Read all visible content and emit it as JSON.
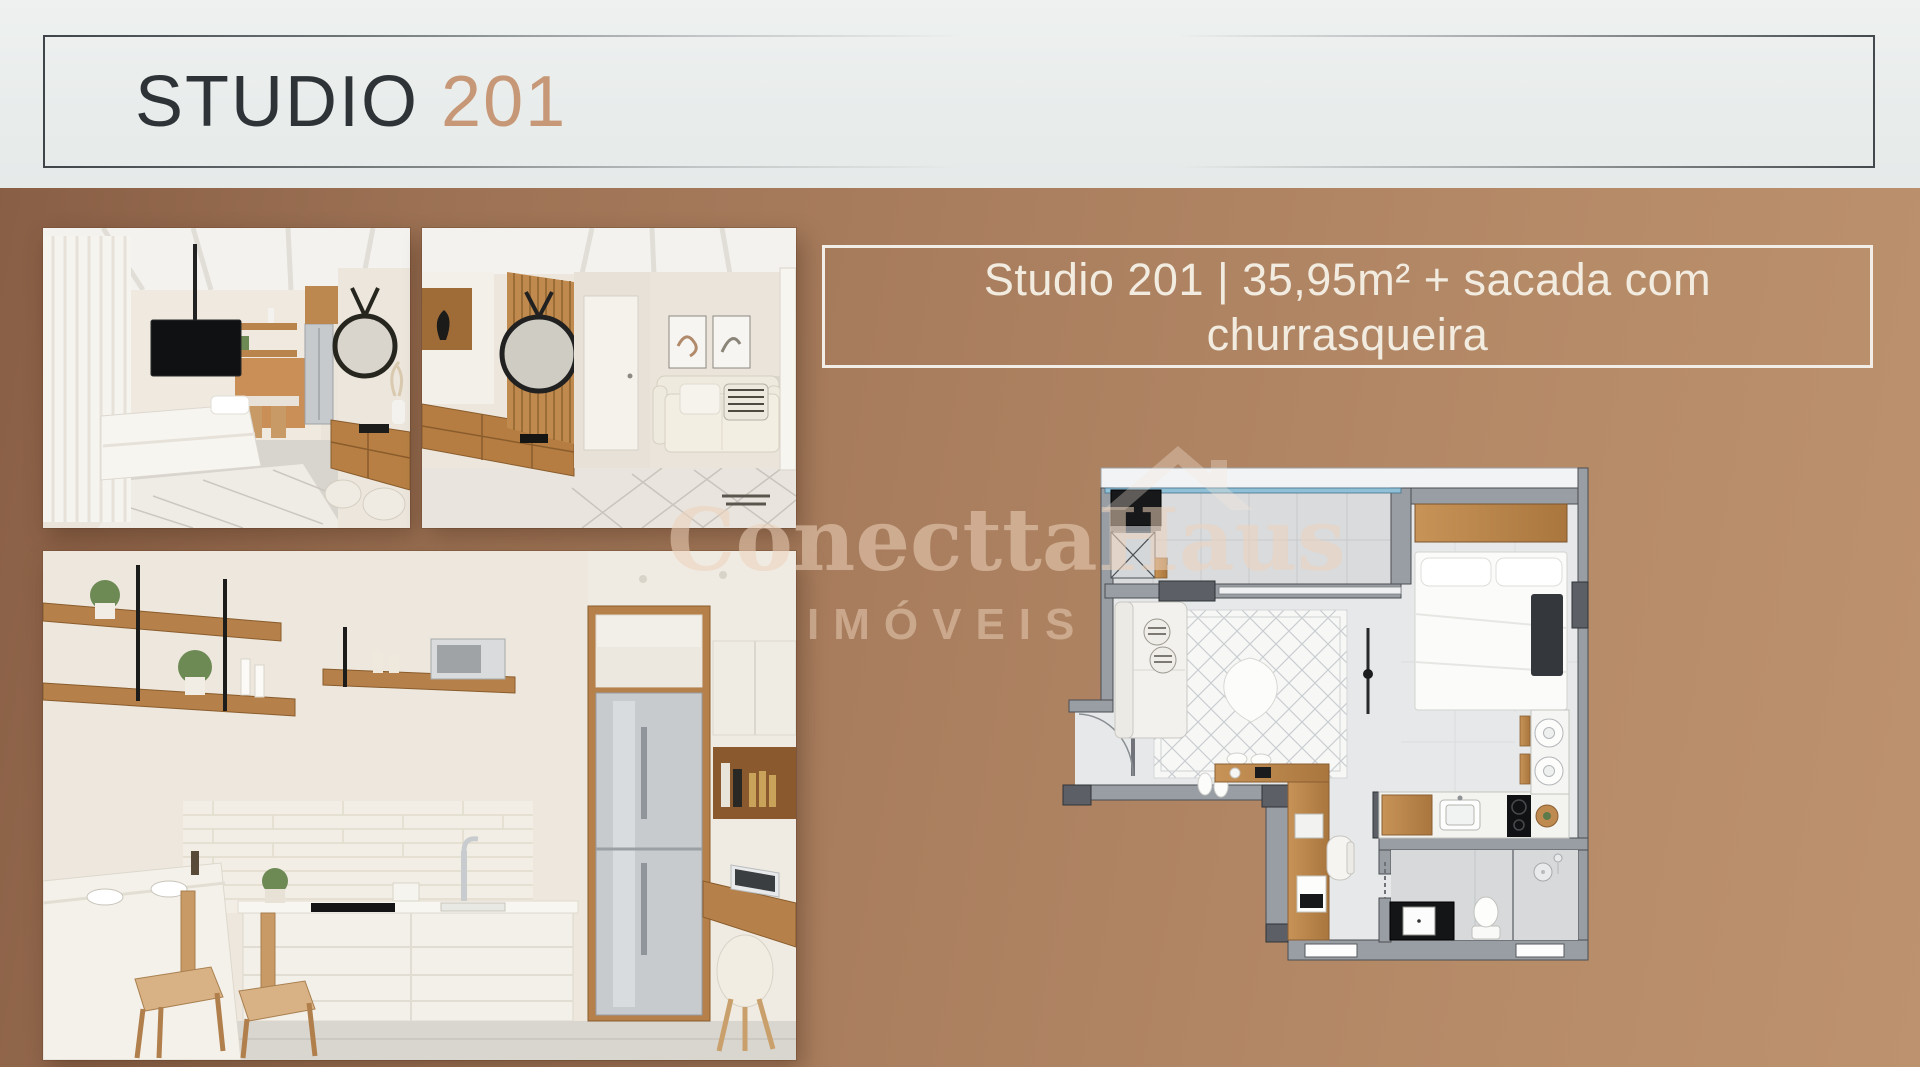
{
  "header": {
    "title": "STUDIO",
    "unit_number": "201"
  },
  "unit_info": {
    "headline": "Studio 201 | 35,95m² + sacada com churrasqueira"
  },
  "watermark": {
    "brand": "ConecttaHaus",
    "tagline": "IMÓVEIS"
  },
  "photos": {
    "photo1_alt": "studio-bedroom-render",
    "photo2_alt": "studio-living-entry-render",
    "photo3_alt": "studio-kitchen-home-office-render"
  },
  "floor_plan": {
    "alt": "studio-201-top-view-floor-plan"
  },
  "colors": {
    "background_light": "#bd926e",
    "background_dark": "#875d44",
    "header_band": "#e9edec",
    "title_dark": "#2e3337",
    "title_accent": "#c69877",
    "info_text": "#f2ebe0",
    "info_border": "#f2eee7",
    "watermark_text": "rgba(236,210,186,0.55)",
    "plan_wall": "#999ea4",
    "plan_floor": "#e6e8e9",
    "plan_glass": "#8fc0d6"
  }
}
